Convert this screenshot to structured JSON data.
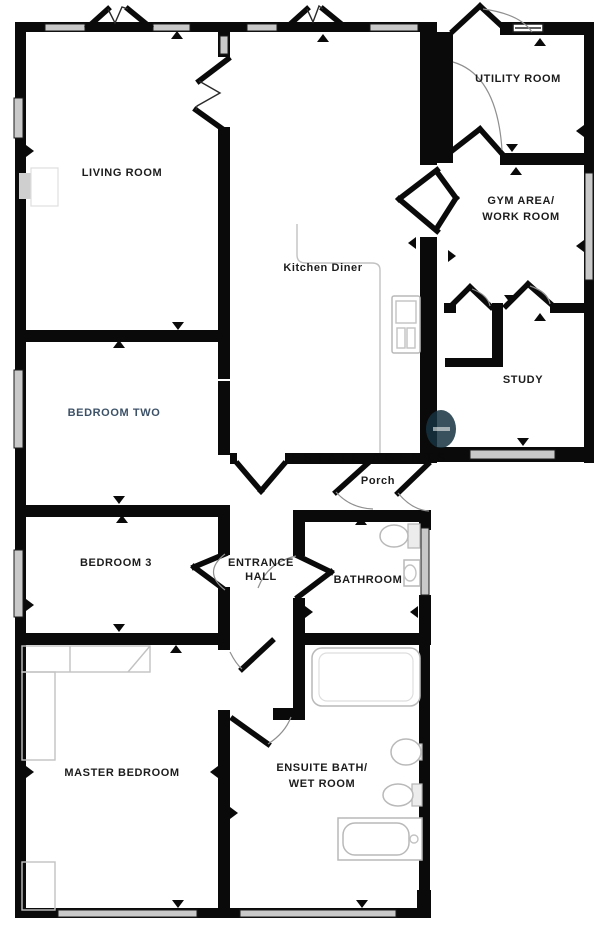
{
  "plan": {
    "rooms": {
      "living_room": {
        "label": "LIVING ROOM"
      },
      "utility_room": {
        "label": "UTILITY ROOM"
      },
      "gym_area": {
        "line1": "GYM AREA/",
        "line2": "WORK ROOM"
      },
      "kitchen_diner": {
        "label": "Kitchen Diner"
      },
      "study": {
        "label": "STUDY"
      },
      "bedroom_two": {
        "label": "BEDROOM TWO"
      },
      "porch": {
        "label": "Porch"
      },
      "bedroom_3": {
        "label": "BEDROOM 3"
      },
      "entrance_hall": {
        "line1": "ENTRANCE",
        "line2": "HALL"
      },
      "bathroom": {
        "label": "BATHROOM"
      },
      "master_bedroom": {
        "label": "MASTER BEDROOM"
      },
      "ensuite": {
        "line1": "ENSUITE BATH/",
        "line2": "WET ROOM"
      }
    },
    "watermark": {
      "text": "ESTATE AGENTS"
    },
    "colors": {
      "wall": "#0a0a0a",
      "window_fill": "#c9c9c9",
      "fixture_stroke": "#b9b9b9",
      "label": "#1c1c1c",
      "bedroom_two_label": "#3d5268",
      "watermark": "#15323f"
    }
  }
}
